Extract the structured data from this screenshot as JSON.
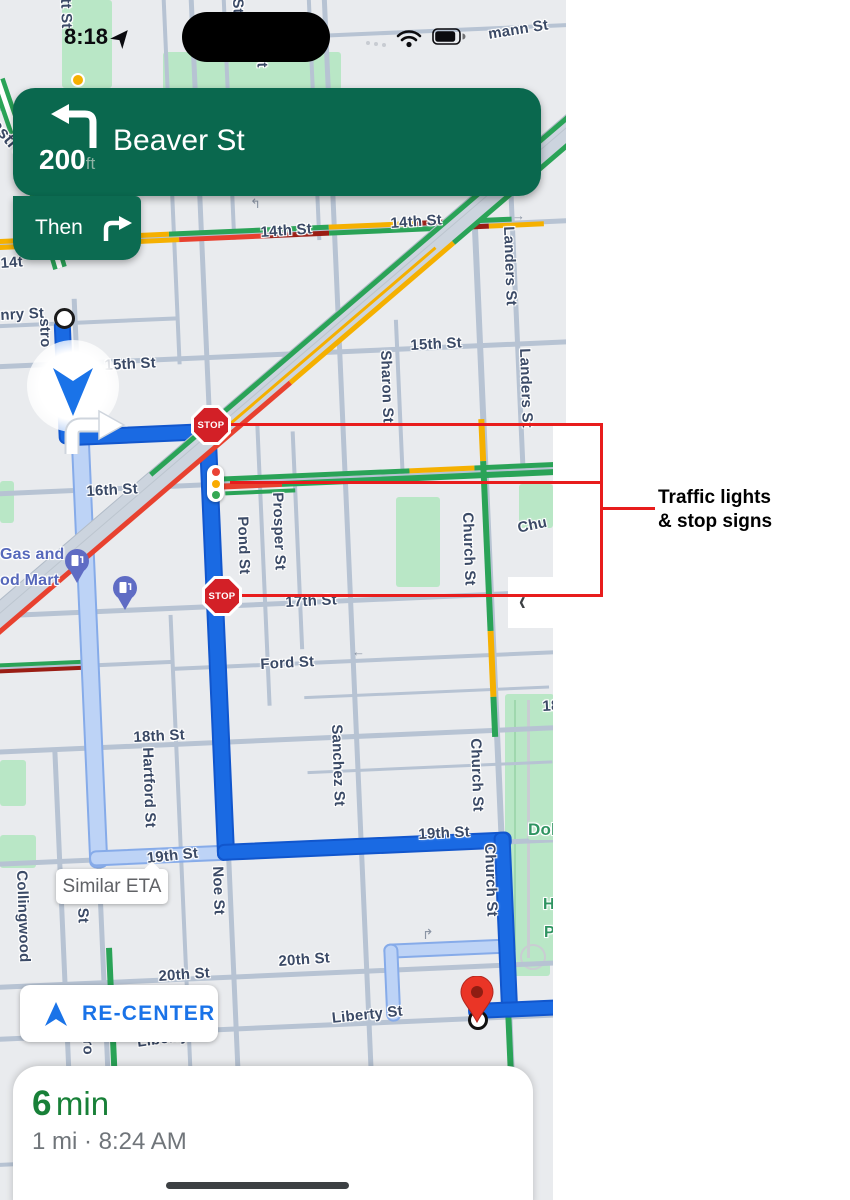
{
  "status_bar": {
    "time": "8:18"
  },
  "navigation_banner": {
    "distance": "200",
    "distance_unit": "ft",
    "street": "Beaver St",
    "then_label": "Then"
  },
  "map": {
    "stop_sign_label": "STOP",
    "similar_eta_label": "Similar ETA",
    "labels": [
      {
        "t": "tt St",
        "x": 74,
        "y": -2,
        "r": 88
      },
      {
        "t": "St",
        "x": 246,
        "y": -2,
        "r": 88
      },
      {
        "t": "St",
        "x": 270,
        "y": 52,
        "r": 88
      },
      {
        "t": "mann St",
        "x": 487,
        "y": 26,
        "r": -9
      },
      {
        "t": "astro S",
        "x": 2,
        "y": 116,
        "r": 50,
        "s": 17
      },
      {
        "t": "14th St",
        "x": 260,
        "y": 224,
        "r": -4
      },
      {
        "t": "14th St",
        "x": 390,
        "y": 215,
        "r": -4
      },
      {
        "t": "14t",
        "x": 0,
        "y": 255,
        "r": -4
      },
      {
        "t": "nry St",
        "x": 0,
        "y": 307,
        "r": -3
      },
      {
        "t": "stro",
        "x": 53,
        "y": 318,
        "r": 88
      },
      {
        "t": "15th St",
        "x": 104,
        "y": 357,
        "r": -3
      },
      {
        "t": "15th St",
        "x": 410,
        "y": 337,
        "r": -3
      },
      {
        "t": "Landers St",
        "x": 517,
        "y": 226,
        "r": 88
      },
      {
        "t": "Landers St",
        "x": 533,
        "y": 348,
        "r": 88
      },
      {
        "t": "Sharon St",
        "x": 394,
        "y": 350,
        "r": 88
      },
      {
        "t": "16th St",
        "x": 86,
        "y": 483,
        "r": -3
      },
      {
        "t": "Pond St",
        "x": 251,
        "y": 516,
        "r": 88
      },
      {
        "t": "Prosper St",
        "x": 286,
        "y": 492,
        "r": 88
      },
      {
        "t": "Church St",
        "x": 476,
        "y": 512,
        "r": 88
      },
      {
        "t": "Chu",
        "x": 516,
        "y": 520,
        "r": -12
      },
      {
        "t": "17th St",
        "x": 285,
        "y": 594,
        "r": -3
      },
      {
        "t": "Gas and",
        "x": 0,
        "y": 546,
        "r": 0,
        "c": "poi",
        "s": 16
      },
      {
        "t": "od Mart",
        "x": 0,
        "y": 572,
        "r": 0,
        "c": "poi",
        "s": 16
      },
      {
        "t": "Ford St",
        "x": 260,
        "y": 656,
        "r": -3
      },
      {
        "t": "18th St",
        "x": 133,
        "y": 729,
        "r": -3
      },
      {
        "t": "18",
        "x": 542,
        "y": 698,
        "r": -3
      },
      {
        "t": "Hartford St",
        "x": 156,
        "y": 747,
        "r": 88
      },
      {
        "t": "Sanchez St",
        "x": 345,
        "y": 724,
        "r": 88
      },
      {
        "t": "Church St",
        "x": 484,
        "y": 738,
        "r": 88
      },
      {
        "t": "Church St",
        "x": 498,
        "y": 843,
        "r": 88
      },
      {
        "t": "Dol",
        "x": 528,
        "y": 820,
        "r": 0,
        "c": "park",
        "s": 17
      },
      {
        "t": "H",
        "x": 543,
        "y": 896,
        "r": 0,
        "c": "park",
        "s": 16
      },
      {
        "t": "P",
        "x": 544,
        "y": 924,
        "r": 0,
        "c": "park",
        "s": 16
      },
      {
        "t": "19th St",
        "x": 146,
        "y": 850,
        "r": -6
      },
      {
        "t": "19th St",
        "x": 418,
        "y": 826,
        "r": -3
      },
      {
        "t": "Collingwood",
        "x": 30,
        "y": 870,
        "r": 88
      },
      {
        "t": "stro St",
        "x": 90,
        "y": 874,
        "r": 88
      },
      {
        "t": "Noe St",
        "x": 226,
        "y": 866,
        "r": 88
      },
      {
        "t": "20th St",
        "x": 158,
        "y": 968,
        "r": -4
      },
      {
        "t": "20th St",
        "x": 278,
        "y": 953,
        "r": -4
      },
      {
        "t": "Liberty St",
        "x": 331,
        "y": 1010,
        "r": -6
      },
      {
        "t": "Liberty St",
        "x": 136,
        "y": 1034,
        "r": -8
      },
      {
        "t": "tro",
        "x": 96,
        "y": 1034,
        "r": 88
      },
      {
        "t": "←",
        "x": 352,
        "y": 644,
        "r": 0,
        "c": "gray",
        "s": 13
      },
      {
        "t": "→",
        "x": 512,
        "y": 208,
        "r": 0,
        "c": "gray",
        "s": 13
      },
      {
        "t": "↰",
        "x": 250,
        "y": 196,
        "r": 0,
        "c": "gray",
        "s": 13
      },
      {
        "t": "↱",
        "x": 422,
        "y": 926,
        "r": 0,
        "c": "gray",
        "s": 14
      }
    ]
  },
  "controls": {
    "recenter_label": "RE-CENTER"
  },
  "route_summary": {
    "eta_value": "6",
    "eta_unit": "min",
    "details": "1 mi · 8:24 AM"
  },
  "annotation": {
    "line1": "Traffic lights",
    "line2": "& stop signs"
  },
  "colors": {
    "banner_green": "#0a684e",
    "route_blue": "#1a6ae3",
    "alt_route_blue": "#bdd3f6",
    "annotation_red": "#e81c1c",
    "traffic_green": "#2aa357",
    "traffic_yellow": "#f5b000",
    "traffic_red": "#e8412f",
    "traffic_dark_red": "#9a1d14",
    "eta_green": "#188038",
    "recenter_blue": "#1a73e8",
    "map_bg": "#e9ebee",
    "park_green": "#b9e7c6"
  }
}
